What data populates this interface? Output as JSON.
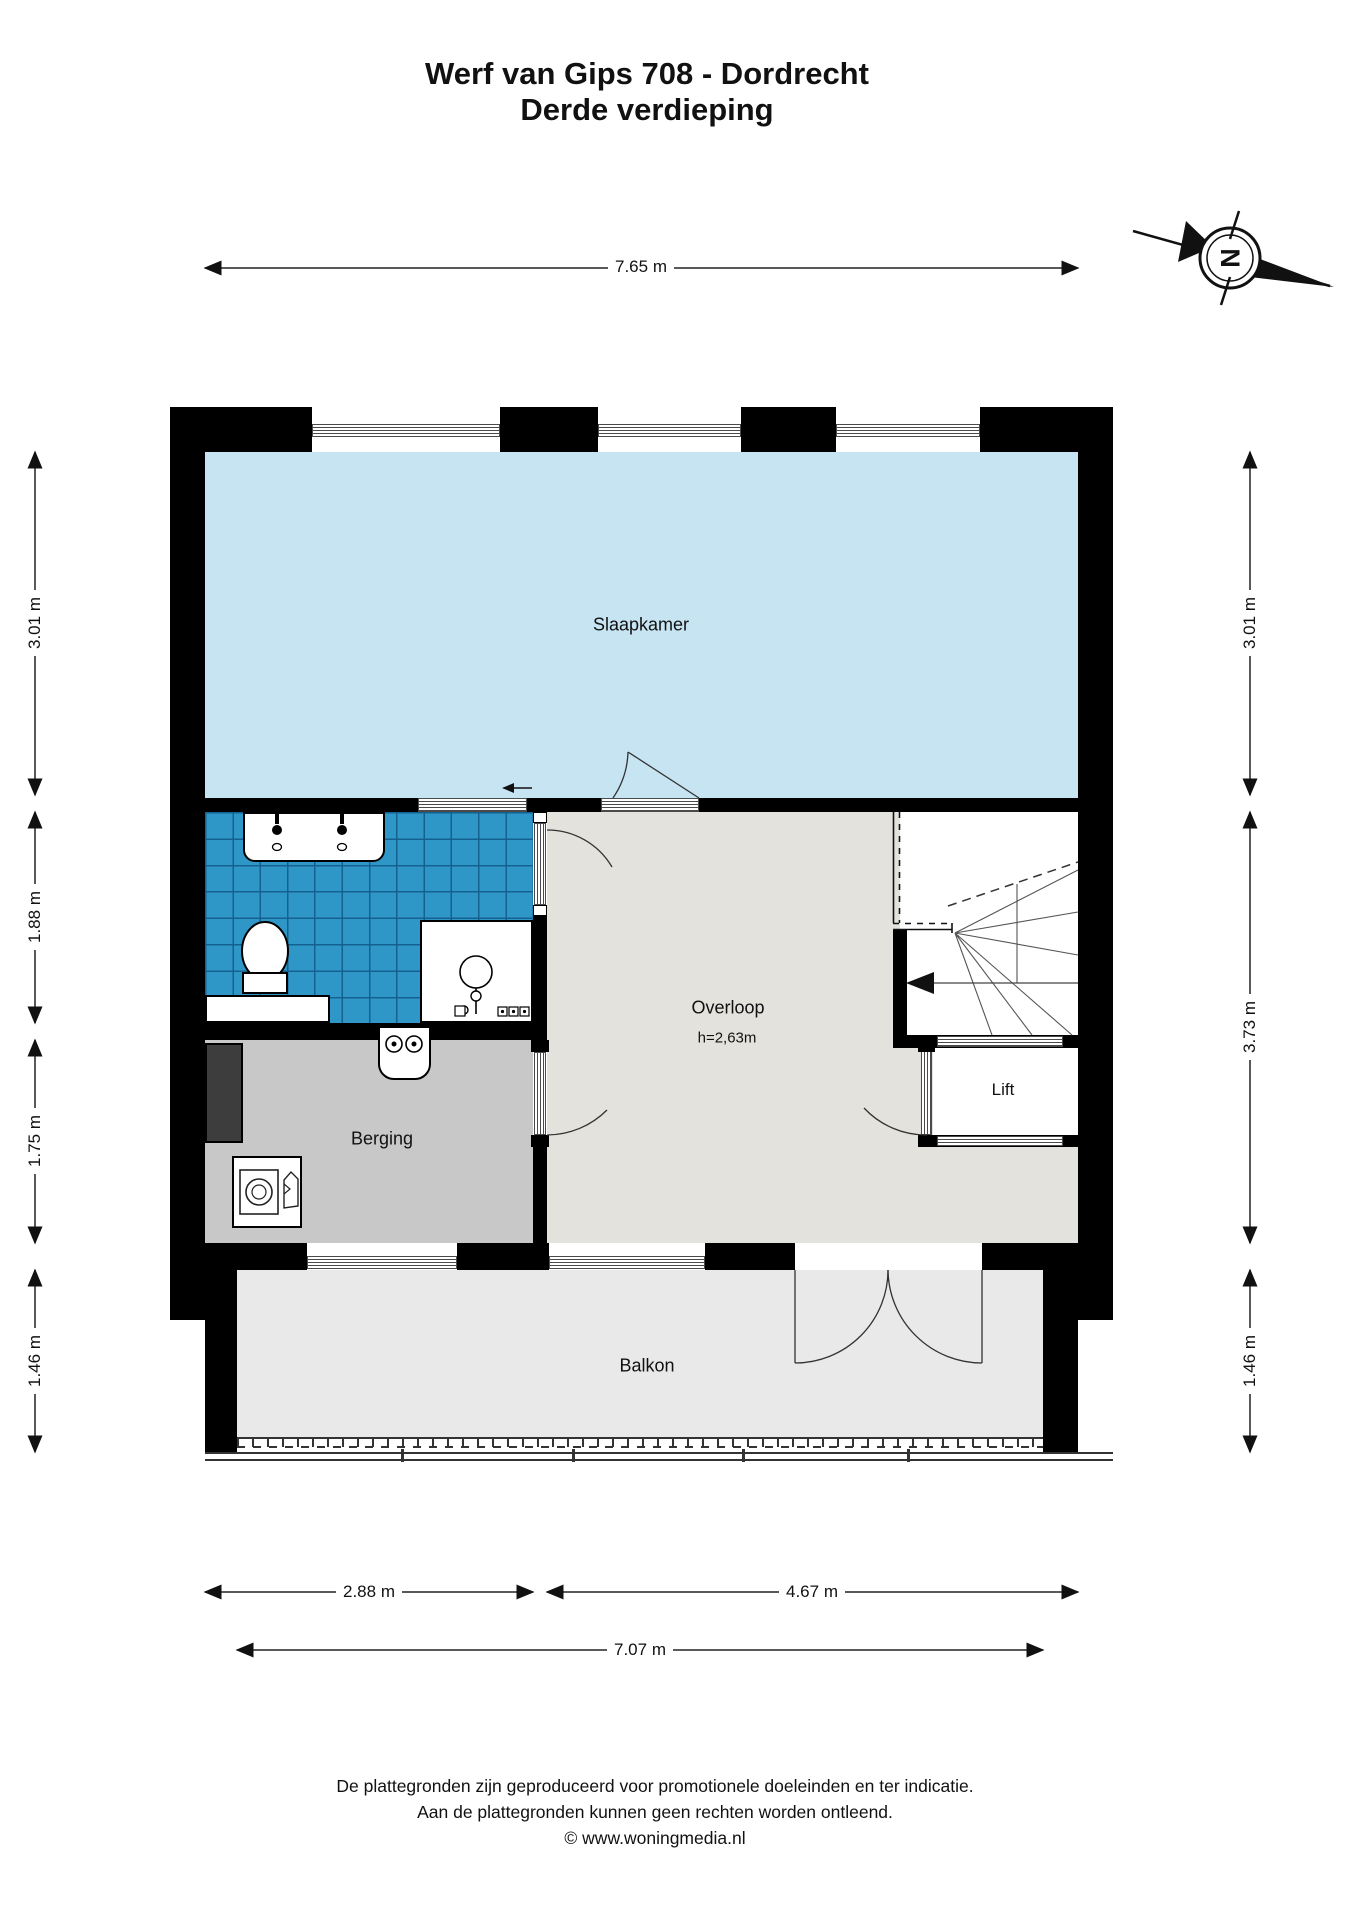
{
  "title": {
    "line1": "Werf van Gips 708 - Dordrecht",
    "line2": "Derde verdieping"
  },
  "compass": {
    "north_label": "N"
  },
  "rooms": {
    "slaapkamer": "Slaapkamer",
    "overloop": "Overloop",
    "overloop_height": "h=2,63m",
    "lift": "Lift",
    "berging": "Berging",
    "balkon": "Balkon"
  },
  "dimensions": {
    "top": "7.65 m",
    "left": [
      "3.01 m",
      "1.88 m",
      "1.75 m",
      "1.46 m"
    ],
    "right": [
      "3.01 m",
      "3.73 m",
      "1.46 m"
    ],
    "bottom": [
      "2.88 m",
      "4.67 m"
    ],
    "bottom_total": "7.07 m"
  },
  "footer": {
    "line1": "De plattegronden zijn geproduceerd voor promotionele doeleinden en ter indicatie.",
    "line2": "Aan de plattegronden kunnen geen rechten worden ontleend.",
    "line3": "© www.woningmedia.nl"
  },
  "colors": {
    "wall": "#000000",
    "slaapkamer": "#c6e4f1",
    "bathroom_tile": "#2f96c8",
    "bathroom_grout": "#14618f",
    "overloop": "#e3e2dd",
    "berging": "#c8c8c8",
    "balkon": "#e9e9e9",
    "shaft": "#3d3d3d",
    "line": "#222222"
  }
}
